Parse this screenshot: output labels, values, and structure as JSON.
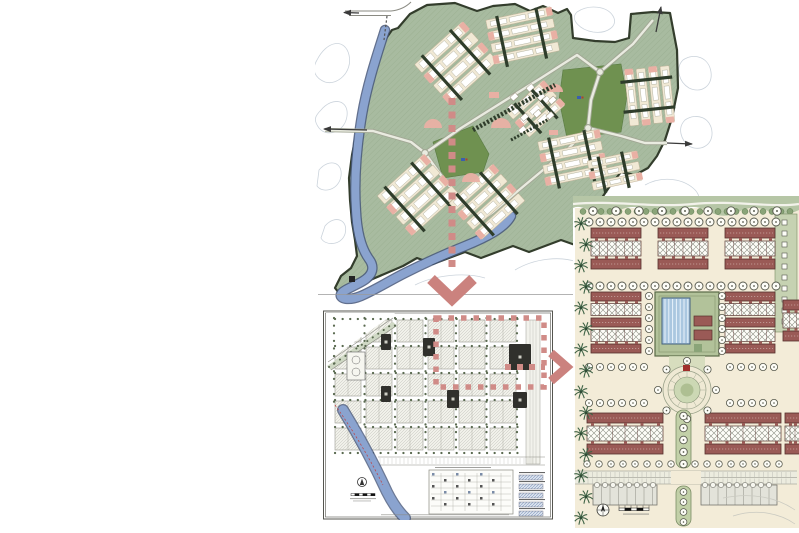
{
  "page": {
    "width": 799,
    "height": 533,
    "background": "#ffffff"
  },
  "figure": {
    "kind": "urban-design zoom sequence of three site plans",
    "panels": [
      {
        "id": "master-plan",
        "role": "illustrative masterplan with river edge, two parks, housing clusters and exit-road arrows"
      },
      {
        "id": "district-plan",
        "role": "technical site-plan sheet with street grid, river, legend table, north-arrow and scale-bar"
      },
      {
        "id": "detail-plan",
        "role": "neighbourhood block plan with courtyard swimming pool, circular plaza, palm-lined street, compass and scale-bar"
      }
    ],
    "connectors": [
      {
        "id": "arrow-down",
        "type": "dashed-arrow",
        "direction": "down",
        "from": "master-plan",
        "to": "district-plan"
      },
      {
        "id": "focus-rectangle",
        "type": "dashed-rectangle",
        "on": "district-plan"
      },
      {
        "id": "arrow-right",
        "type": "dashed-arrow",
        "direction": "right",
        "from": "district-plan",
        "to": "detail-plan"
      }
    ],
    "notes": "all lettering on the sheets (scale bars, legend, title blocks) is smaller than legibility and drawn as micro-marks"
  },
  "palette": {
    "connector": "#d08b87",
    "connector_head": "#cb827e",
    "site_green": "#a8bba0",
    "site_hatch": "#8ea383",
    "boundary": "#333d2c",
    "park_green": "#6f9150",
    "river": "#8aa3cf",
    "river_edge": "#47577a",
    "cream": "#f1e9d5",
    "white_bldg": "#ffffff",
    "pink": "#e9b0a4",
    "dark_bar": "#2f3d2b",
    "road_fill": "#e9ebe0",
    "road_edge": "#a2a795",
    "contour": "#c6cfd8",
    "ink": "#3a3a3a",
    "sheet_line": "#55554f",
    "block_fill": "#f1f1ea",
    "block_hatch": "#b9b9b0",
    "plan_dark": "#30302c",
    "tree": "#5a6a50",
    "wedge_green": "#cfd8c4",
    "boulevard": "#f2f2ec",
    "red_dash": "#c04040",
    "ground": "#f3ecd8",
    "maroon": "#9a5a56",
    "maroon_line": "#55302c",
    "xh_line": "#8b8e83",
    "pool": "#aac7e0",
    "pool_edge": "#44607e",
    "courtyard": "#b2c29a",
    "mall": "#cfdab8",
    "band": "#b6c6a6",
    "bush": "#8aa478",
    "palm": "#3e6245",
    "median": "#c2d0a8",
    "median_edge": "#7a8c64",
    "gray_bldg": "#e3e3da",
    "gray_line": "#76766e",
    "micro": "#8a8a86"
  }
}
